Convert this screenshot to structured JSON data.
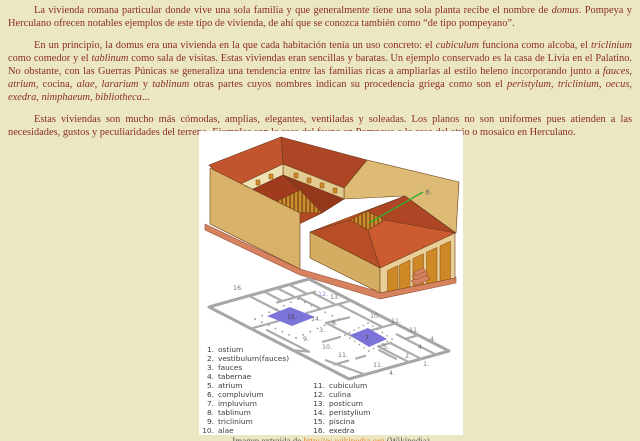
{
  "page": {
    "background": "#ebe7c3",
    "text_color": "#8b2c2c"
  },
  "paragraphs": [
    {
      "runs": [
        {
          "t": "La vivienda romana particular donde vive una sola familia y que generalmente tiene una sola planta recibe el nombre de ",
          "i": false
        },
        {
          "t": "domus",
          "i": true
        },
        {
          "t": ". Pompeya y Herculano ofrecen notables ejemplos de este tipo de vivienda, de ahí que se conozca también como “de tipo pompeyano”.",
          "i": false
        }
      ]
    },
    {
      "runs": [
        {
          "t": "En un principio, la domus era una vivienda en la que cada habitación tenía un uso concreto: el ",
          "i": false
        },
        {
          "t": "cubiculum",
          "i": true
        },
        {
          "t": " funciona como alcoba, el ",
          "i": false
        },
        {
          "t": "triclinium",
          "i": true
        },
        {
          "t": " como comedor y el ",
          "i": false
        },
        {
          "t": "tablinum",
          "i": true
        },
        {
          "t": " como sala de visitas. Estas viviendas eran sencillas y baratas. Un ejemplo conservado es la casa de Livia en el Palatino. No obstante, con las Guerras Púnicas se generaliza una tendencia entre las familias ricas a ampliarlas al estilo heleno incorporando junto a ",
          "i": false
        },
        {
          "t": "fauces",
          "i": true
        },
        {
          "t": ", ",
          "i": false
        },
        {
          "t": "atrium",
          "i": true
        },
        {
          "t": ", cocina, ",
          "i": false
        },
        {
          "t": "alae",
          "i": true
        },
        {
          "t": ", ",
          "i": false
        },
        {
          "t": "lararium",
          "i": true
        },
        {
          "t": " y ",
          "i": false
        },
        {
          "t": "tablinum",
          "i": true
        },
        {
          "t": " otras partes cuyos nombres indican su procedencia griega como son el ",
          "i": false
        },
        {
          "t": "peristylum",
          "i": true
        },
        {
          "t": ", ",
          "i": false
        },
        {
          "t": "triclinium",
          "i": true
        },
        {
          "t": ", ",
          "i": false
        },
        {
          "t": "oecus",
          "i": true
        },
        {
          "t": ", ",
          "i": false
        },
        {
          "t": "exedra",
          "i": true
        },
        {
          "t": ", ",
          "i": false
        },
        {
          "t": "nimphaeum",
          "i": true
        },
        {
          "t": ", ",
          "i": false
        },
        {
          "t": "bibliotheca",
          "i": true
        },
        {
          "t": "...",
          "i": false
        }
      ]
    },
    {
      "runs": [
        {
          "t": "Estas viviendas son mucho más cómodas, amplias, elegantes, ventiladas y soleadas. Los planos no son uniformes pues atienden a las necesidades, gustos y peculiaridades del terreno. Ejemplos son la casa del fauno en Pompeya o la casa del atrio o mosaico en Herculano.",
          "i": false
        }
      ]
    }
  ],
  "figure": {
    "panel_bg": "#ffffff",
    "callout": {
      "label": "6.",
      "x1": 170,
      "y1": 92,
      "x2": 224,
      "y2": 61,
      "lx": 226.5,
      "ly": 63.5,
      "color": "#2eae2e"
    },
    "colors": {
      "roof": "#c2552d",
      "roof_shadow": "#9e3e1e",
      "wall_tan": "#d9b26a",
      "base_salmon": "#d6825f",
      "stripe_bg": "#ce8b2f",
      "stripe_bar": "#7a4e14",
      "pool": "#7d74da",
      "pool_border": "#4a46a8",
      "plan_wall": "#a6a6a6"
    },
    "plan_labels": [
      {
        "t": "16.",
        "x": 34,
        "y": 159
      },
      {
        "t": "12.",
        "x": 119,
        "y": 165,
        "c": "alt"
      },
      {
        "t": "13.",
        "x": 131,
        "y": 168
      },
      {
        "t": "15.",
        "x": 88,
        "y": 188,
        "c": "dark"
      },
      {
        "t": "14.",
        "x": 112,
        "y": 190
      },
      {
        "t": "8.",
        "x": 133,
        "y": 194
      },
      {
        "t": "3.",
        "x": 120,
        "y": 201
      },
      {
        "t": "10.",
        "x": 171,
        "y": 187
      },
      {
        "t": "11.",
        "x": 192,
        "y": 192
      },
      {
        "t": "11.",
        "x": 210,
        "y": 201
      },
      {
        "t": "4.",
        "x": 231,
        "y": 210
      },
      {
        "t": "4.",
        "x": 219,
        "y": 218
      },
      {
        "t": "9.",
        "x": 104,
        "y": 210
      },
      {
        "t": "10.",
        "x": 123,
        "y": 218
      },
      {
        "t": "7.",
        "x": 166,
        "y": 209,
        "c": "dark"
      },
      {
        "t": "5.",
        "x": 184,
        "y": 218
      },
      {
        "t": "11.",
        "x": 139,
        "y": 226
      },
      {
        "t": "2.",
        "x": 206,
        "y": 227
      },
      {
        "t": "11.",
        "x": 174,
        "y": 236
      },
      {
        "t": "1.",
        "x": 224,
        "y": 235
      },
      {
        "t": "4.",
        "x": 190,
        "y": 244
      }
    ],
    "legend": {
      "items": [
        {
          "num": "1.",
          "label": "ostium"
        },
        {
          "num": "2.",
          "label": "vestibulum(fauces)"
        },
        {
          "num": "3.",
          "label": "fauces"
        },
        {
          "num": "4.",
          "label": "tabernae"
        },
        {
          "num": "5.",
          "label": "atrium"
        },
        {
          "num": "6.",
          "label": "compluvium"
        },
        {
          "num": "7.",
          "label": "impluvium"
        },
        {
          "num": "8.",
          "label": "tablinum"
        },
        {
          "num": "9.",
          "label": "triclinium"
        },
        {
          "num": "10.",
          "label": "alae"
        },
        {
          "num": "11.",
          "label": "cubiculum"
        },
        {
          "num": "12.",
          "label": "culina"
        },
        {
          "num": "13.",
          "label": "posticum"
        },
        {
          "num": "14.",
          "label": "peristylium"
        },
        {
          "num": "15.",
          "label": "piscina"
        },
        {
          "num": "16.",
          "label": "exedra"
        }
      ]
    },
    "caption": {
      "prefix": "Imagen extraída de ",
      "link": "http://es.wikipedia.org",
      "suffix": " (Wikipedia)",
      "link_color": "#e8862e"
    }
  }
}
